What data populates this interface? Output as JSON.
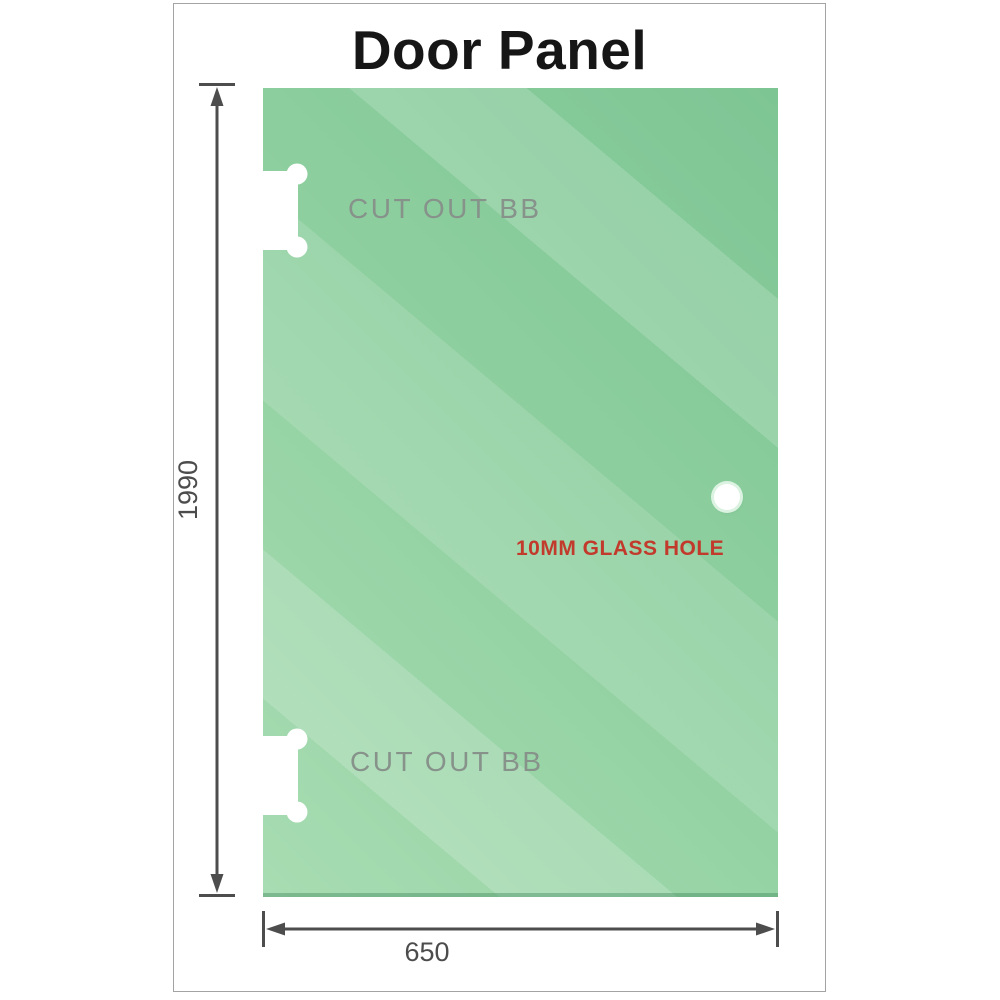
{
  "title": "Door Panel",
  "drawing": {
    "height_dimension": "1990",
    "width_dimension": "650",
    "cutouts": [
      {
        "label": "CUT OUT BB"
      },
      {
        "label": "CUT OUT BB"
      }
    ],
    "hole": {
      "label": "10MM GLASS HOLE"
    }
  },
  "colors": {
    "glass_dark": "#7ec594",
    "glass_base": "#8ecf9f",
    "glass_highlight": "#a8dcb2",
    "dimension_line": "#4d4d4d",
    "dimension_text": "#4c4c4c",
    "cutout_text": "#87928b",
    "hole_label_text": "#c23a2c",
    "card_border": "#a3a3a3"
  }
}
